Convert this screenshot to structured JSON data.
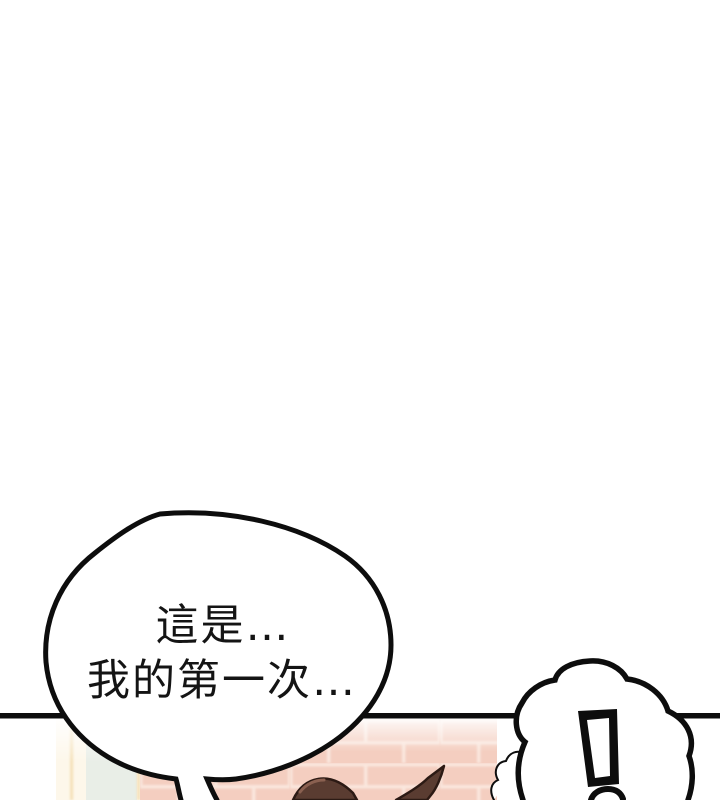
{
  "page": {
    "kind": "comic-panel-page",
    "background_color": "#ffffff"
  },
  "dialogue": {
    "speech_bubble": {
      "line1": "這是…",
      "line2": "我的第一次…",
      "text_color": "#141414",
      "fill_color": "#ffffff",
      "outline_color": "#0d0d0d"
    },
    "shock_bubble": {
      "text": "!",
      "fill_color": "#ffffff",
      "outline_color": "#0d0d0d",
      "mark_color": "#0d0d0d"
    }
  },
  "scene": {
    "panel_border_color": "#0d0d0d",
    "brick_wall_color": "#f4cec0",
    "brick_mortar_color": "#fae8df",
    "door_cream_color": "#fdf7ea",
    "door_trim_color": "#f3dcae",
    "door_mint_color": "#e9eee7",
    "hair_color": "#5a3c31",
    "hair_outline_color": "#2c1a14",
    "hair_highlight_color": "#8a6050"
  }
}
